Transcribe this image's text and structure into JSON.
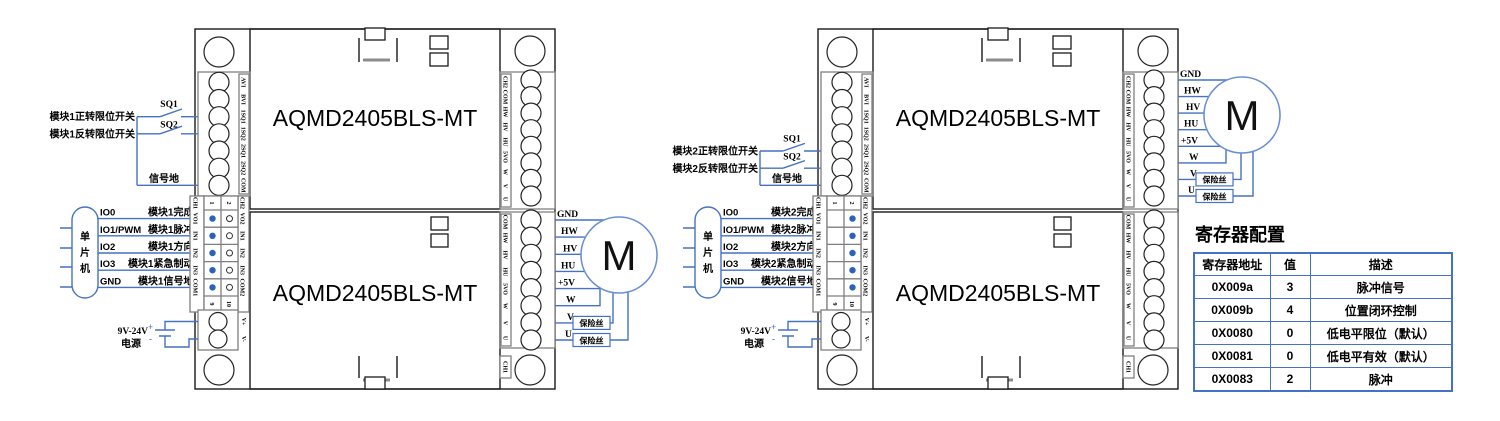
{
  "shared": {
    "board_name": "AQMD2405BLS-MT",
    "motor_label": "M",
    "fuse_label": "保险丝",
    "sq1": "SQ1",
    "sq2": "SQ2",
    "signal_ground": "信号地",
    "mcu_chars": [
      "单",
      "片",
      "机"
    ],
    "power_supply": {
      "line1": "9V-24V",
      "line2": "电源",
      "plus": "+",
      "minus": "-"
    },
    "motor_wires": [
      "GND",
      "HW",
      "HV",
      "HU",
      "+5V",
      "W",
      "V",
      "U"
    ],
    "terminals": {
      "left": [
        "AVI",
        "BVI",
        "1SQ1",
        "1SQ2",
        "2SQ1",
        "2SQ2",
        "COM"
      ],
      "right_top": [
        "CH2",
        "COM",
        "HW",
        "HV",
        "HU",
        "5VO",
        "W",
        "V",
        "U"
      ],
      "right_bottom": [
        "COM",
        "HW",
        "HV",
        "HU",
        "5VO",
        "W",
        "V",
        "U",
        "CH1"
      ],
      "power": [
        "V+",
        "V-"
      ],
      "header": {
        "ch1": "CH1",
        "ch2": "CH2",
        "cols": [
          "1",
          "2"
        ],
        "bottom": [
          "9",
          "10"
        ],
        "ch1_pins": [
          "VO1",
          "IN1",
          "IN2",
          "IN3",
          "COM1"
        ],
        "ch2_pins": [
          "VO2",
          "IN1",
          "IN2",
          "IN3",
          "COM2"
        ]
      }
    }
  },
  "module1": {
    "forward_limit": "模块1正转限位开关",
    "reverse_limit": "模块1反转限位开关",
    "io": [
      {
        "pin": "IO0",
        "signal": "模块1完成"
      },
      {
        "pin": "IO1/PWM",
        "signal": "模块1脉冲"
      },
      {
        "pin": "IO2",
        "signal": "模块1方向"
      },
      {
        "pin": "IO3",
        "signal": "模块1紧急制动"
      },
      {
        "pin": "GND",
        "signal": "模块1信号地"
      }
    ]
  },
  "module2": {
    "forward_limit": "模块2正转限位开关",
    "reverse_limit": "模块2反转限位开关",
    "io": [
      {
        "pin": "IO0",
        "signal": "模块2完成"
      },
      {
        "pin": "IO1/PWM",
        "signal": "模块2脉冲"
      },
      {
        "pin": "IO2",
        "signal": "模块2方向"
      },
      {
        "pin": "IO3",
        "signal": "模块2紧急制动"
      },
      {
        "pin": "GND",
        "signal": "模块2信号地"
      }
    ]
  },
  "register_table": {
    "title": "寄存器配置",
    "headers": [
      "寄存器地址",
      "值",
      "描述"
    ],
    "rows": [
      [
        "0X009a",
        "3",
        "脉冲信号"
      ],
      [
        "0X009b",
        "4",
        "位置闭环控制"
      ],
      [
        "0X0080",
        "0",
        "低电平限位（默认）"
      ],
      [
        "0X0081",
        "0",
        "低电平有效（默认）"
      ],
      [
        "0X0083",
        "2",
        "脉冲"
      ]
    ]
  },
  "colors": {
    "wire": "#4472c4",
    "motor_outline": "#6b8fd4",
    "block_border": "#7f7f7f",
    "table_border": "#4472c4",
    "dot_fill": "#2e62b8"
  }
}
